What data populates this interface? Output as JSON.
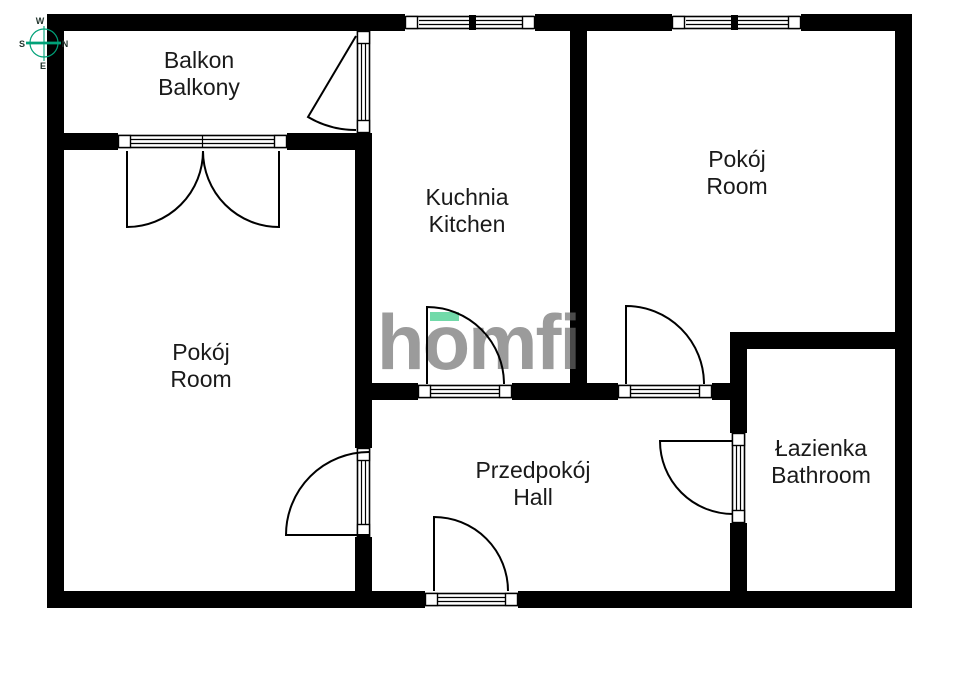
{
  "plan_title": "Apartment floor plan",
  "rooms": [
    {
      "id": "balcony",
      "name_pl": "Balkon",
      "name_en": "Balkony"
    },
    {
      "id": "kitchen",
      "name_pl": "Kuchnia",
      "name_en": "Kitchen"
    },
    {
      "id": "room-right",
      "name_pl": "Pokój",
      "name_en": "Room"
    },
    {
      "id": "room-left",
      "name_pl": "Pokój",
      "name_en": "Room"
    },
    {
      "id": "hall",
      "name_pl": "Przedpokój",
      "name_en": "Hall"
    },
    {
      "id": "bathroom",
      "name_pl": "Łazienka",
      "name_en": "Bathroom"
    }
  ],
  "compass": {
    "top": "W",
    "right": "N",
    "left": "S",
    "bottom": "E",
    "accent_color": "#00a178"
  },
  "watermark": {
    "text": "homfi",
    "color": "#6d6d6d",
    "accent_color": "#58d49a"
  },
  "colors": {
    "walls": "#000000",
    "background": "#ffffff",
    "label_text": "#1a1a1a"
  }
}
